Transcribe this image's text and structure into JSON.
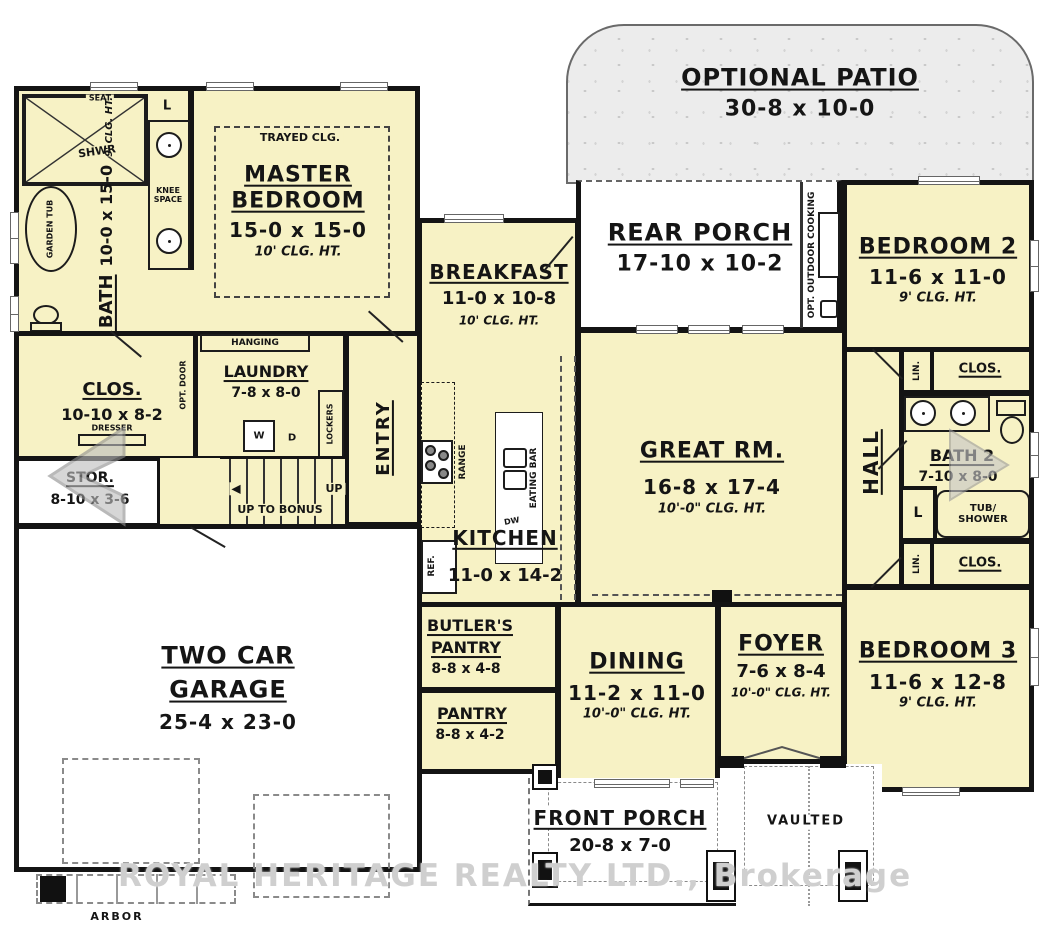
{
  "watermark": "ROYAL HERITAGE REALTY LTD., Brokerage",
  "rooms": {
    "optional_patio": {
      "name": "OPTIONAL PATIO",
      "dims": "30-8 x 10-0"
    },
    "rear_porch": {
      "name": "REAR PORCH",
      "dims": "17-10 x 10-2"
    },
    "bedroom2": {
      "name": "BEDROOM 2",
      "dims": "11-6 x 11-0",
      "clg": "9' CLG. HT."
    },
    "master_bedroom": {
      "name1": "MASTER",
      "name2": "BEDROOM",
      "dims": "15-0 x 15-0",
      "clg": "10' CLG. HT.",
      "note": "TRAYED CLG."
    },
    "m_bath": {
      "name": "M. BATH",
      "dims": "10-0 x 15-0",
      "clg": "9' CLG. HT."
    },
    "breakfast": {
      "name": "BREAKFAST",
      "dims": "11-0 x 10-8",
      "clg": "10' CLG. HT."
    },
    "great_rm": {
      "name": "GREAT RM.",
      "dims": "16-8 x 17-4",
      "clg": "10'-0\" CLG. HT."
    },
    "kitchen": {
      "name": "KITCHEN",
      "dims": "11-0 x 14-2"
    },
    "hall": {
      "name": "HALL"
    },
    "bath2": {
      "name": "BATH 2",
      "dims": "7-10 x 8-0"
    },
    "bedroom3": {
      "name": "BEDROOM 3",
      "dims": "11-6 x 12-8",
      "clg": "9' CLG. HT."
    },
    "foyer": {
      "name": "FOYER",
      "dims": "7-6 x 8-4",
      "clg": "10'-0\" CLG. HT."
    },
    "dining": {
      "name": "DINING",
      "dims": "11-2 x 11-0",
      "clg": "10'-0\" CLG. HT."
    },
    "butlers_pantry": {
      "name1": "BUTLER'S",
      "name2": "PANTRY",
      "dims": "8-8 x 4-8"
    },
    "pantry": {
      "name": "PANTRY",
      "dims": "8-8 x 4-2"
    },
    "front_porch": {
      "name": "FRONT PORCH",
      "dims": "20-8 x 7-0"
    },
    "garage": {
      "name1": "TWO CAR",
      "name2": "GARAGE",
      "dims": "25-4 x 23-0"
    },
    "master_clos": {
      "name": "CLOS.",
      "dims": "10-10 x 8-2"
    },
    "laundry": {
      "name": "LAUNDRY",
      "dims": "7-8 x 8-0"
    },
    "stor": {
      "name": "STOR.",
      "dims": "8-10 x 3-6"
    },
    "entry": {
      "name": "ENTRY"
    },
    "vaulted": {
      "name": "VAULTED"
    },
    "arbor": {
      "name": "ARBOR"
    }
  },
  "fixtures": {
    "seat": "SEAT",
    "shwr": "SHWR",
    "garden_tub": "GARDEN TUB",
    "knee_space": "KNEE SPACE",
    "linen": "L",
    "hanging": "HANGING",
    "opt_door": "OPT. DOOR",
    "dresser": "DRESSER",
    "washer": "W",
    "dryer": "D",
    "lockers": "LOCKERS",
    "up": "UP",
    "up_to_bonus": "UP TO BONUS",
    "slp_clg": "SLP. CLG.",
    "range": "RANGE",
    "ref": "REF.",
    "dw": "DW",
    "eating_bar": "EATING BAR",
    "opt_outdoor_cooking": "OPT. OUTDOOR COOKING",
    "lin": "LIN.",
    "clos": "CLOS.",
    "tub_shower": "TUB/ SHOWER"
  },
  "colors": {
    "room_fill": "#f7f2c5",
    "wall": "#141414",
    "patio_fill": "#ececec",
    "watermark": "#cfcfcf"
  },
  "nav": {
    "prev": "previous-image",
    "next": "next-image"
  }
}
